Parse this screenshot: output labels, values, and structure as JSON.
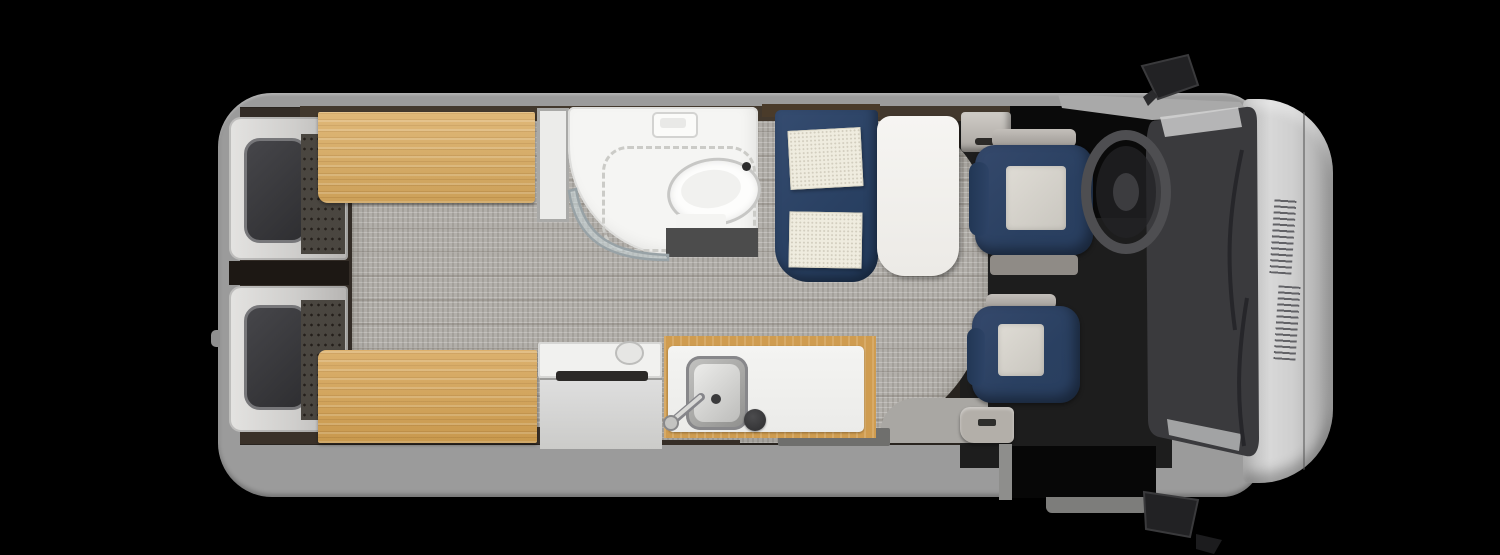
{
  "scene": {
    "type": "rv-floorplan-top-view",
    "label": "Class B camper van floor plan, overhead cutaway view, cab facing right",
    "background_color": "#000000",
    "has_text": false
  },
  "palette": {
    "background": "#000000",
    "body_gray": "#9b9b9b",
    "hood_gray": "#cccccc",
    "windshield_dark": "#3a3a3d",
    "interior_dark": "#29241f",
    "carpet_gray": "#b2afaa",
    "bamboo_wood": "#d9aa5e",
    "navy_upholstery": "#2c4264",
    "cushion_cream": "#efecdf",
    "fixture_white": "#f4f4f2",
    "stainless_steel": "#b9b9b7",
    "window_glass_dark": "#3a3a3c"
  },
  "vehicle": {
    "exterior": {
      "body": {
        "label": "van body shell"
      },
      "hood": {
        "label": "hood and front bumper with vent grilles"
      },
      "windshield": {
        "label": "windshield with wipers"
      },
      "mirror_top": {
        "label": "driver side mirror"
      },
      "mirror_bottom": {
        "label": "passenger side mirror"
      },
      "rear_doors": {
        "label": "rear barn doors with windows",
        "count": 2
      },
      "sliding_door": {
        "label": "open sliding entry door"
      }
    },
    "zones": {
      "bedroom": {
        "label": "rear twin bench beds (bamboo platforms)",
        "bench_left": {
          "label": "bench bed roadside"
        },
        "bench_right": {
          "label": "bench bed curbside"
        }
      },
      "wet_bath": {
        "label": "wet bath",
        "toilet": {
          "label": "toilet"
        },
        "shower": {
          "label": "curved shower enclosure with track"
        },
        "skylight": {
          "label": "roof vent fan"
        },
        "vanity": {
          "label": "dark vanity ledge"
        },
        "cabinet": {
          "label": "tall cabinet"
        }
      },
      "dinette": {
        "label": "front lounge dinette",
        "sofa": {
          "label": "navy L-shaped sofa"
        },
        "cushions": {
          "label": "cream seat cushions",
          "count": 2
        },
        "table": {
          "label": "white pedestal table"
        }
      },
      "galley": {
        "label": "galley kitchen",
        "refrigerator": {
          "label": "refrigerator cabinet with counter lid"
        },
        "counter": {
          "label": "bamboo-trimmed counter"
        },
        "sink": {
          "label": "stainless sink with faucet"
        },
        "burner": {
          "label": "round burner cover"
        }
      },
      "cab": {
        "label": "driver cab",
        "driver_seat": {
          "label": "swivel captain seat driver"
        },
        "passenger_seat": {
          "label": "swivel captain seat passenger"
        },
        "steering_wheel": {
          "label": "steering wheel"
        },
        "entry_step": {
          "label": "entry step at sliding door"
        },
        "carpet": {
          "label": "woven gray flooring"
        }
      }
    }
  }
}
